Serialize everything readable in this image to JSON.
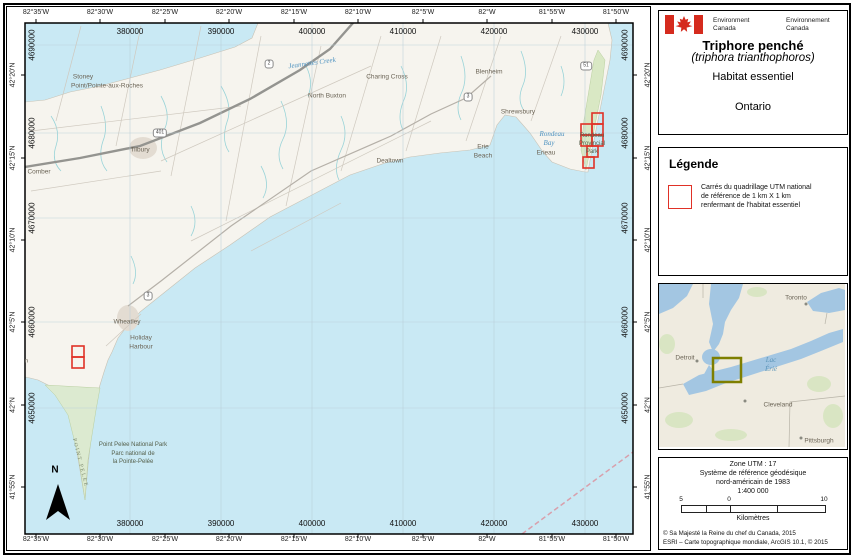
{
  "title_panel": {
    "env_en_1": "Environment",
    "env_en_2": "Canada",
    "env_fr_1": "Environnement",
    "env_fr_2": "Canada",
    "title": "Triphore penché",
    "species": "(triphora trianthophoros)",
    "subtitle": "Habitat essentiel",
    "region": "Ontario"
  },
  "legend": {
    "heading": "Légende",
    "item_line1": "Carrés du quadrillage UTM national",
    "item_line2": "de référence de 1 km X 1 km",
    "item_line3": "renfermant de l'habitat essentiel"
  },
  "inset": {
    "cities": {
      "toronto": "Toronto",
      "detroit": "Detroit",
      "cleveland": "Cleveland",
      "pittsburgh": "Pittsburgh"
    },
    "lake_line1": "Lac",
    "lake_line2": "Érié"
  },
  "info": {
    "zone": "Zone UTM : 17",
    "datum_line1": "Système de référence géodésique",
    "datum_line2": "nord-américain de 1983",
    "scale": "1:400 000",
    "bar_left": "5",
    "bar_zero": "0",
    "bar_right": "10",
    "bar_unit": "Kilomètres",
    "copyright_1": "© Sa Majesté la Reine du chef du Canada, 2015",
    "copyright_2": "ESRI – Carte topographique mondiale, ArcGIS 10.1, © 2015"
  },
  "axes": {
    "lon": [
      "82°35'W",
      "82°30'W",
      "82°25'W",
      "82°20'W",
      "82°15'W",
      "82°10'W",
      "82°5'W",
      "82°W",
      "81°55'W",
      "81°50'W"
    ],
    "lat": [
      "42°20'N",
      "42°15'N",
      "42°10'N",
      "42°5'N",
      "42°N",
      "41°55'N"
    ],
    "eastings": [
      "380000",
      "390000",
      "400000",
      "410000",
      "420000",
      "430000"
    ],
    "northings": [
      "4690000",
      "4680000",
      "4670000",
      "4660000",
      "4650000"
    ]
  },
  "places": {
    "stoney_1": "Stoney",
    "stoney_2": "Point/Pointe-aux-Roches",
    "tilbury": "Tilbury",
    "comber": "Comber",
    "creek": "Jeannettes Creek",
    "charing": "Charing Cross",
    "buxton": "North Buxton",
    "blenheim": "Blenheim",
    "shrewsbury": "Shrewsbury",
    "erieau": "Erieau",
    "erie_beach_1": "Erie",
    "erie_beach_2": "Beach",
    "dealtown": "Dealtown",
    "rondeau_bay_1": "Rondeau",
    "rondeau_bay_2": "Bay",
    "rondeau_park_1": "Rondeau",
    "rondeau_park_2": "Provincial",
    "rondeau_park_3": "Park",
    "wheatley": "Wheatley",
    "holiday_1": "Holiday",
    "holiday_2": "Harbour",
    "leamington": "Leamington",
    "pelee_park_1": "Point Pelee National Park",
    "pelee_park_2": "Parc national de",
    "pelee_park_3": "la Pointe-Pelée",
    "point_pelee": "POINT PELEE"
  },
  "highways": {
    "h401": "401",
    "h2": "2",
    "h3": "3",
    "h51": "51"
  },
  "north_arrow_label": "N",
  "colors": {
    "map_water": "#c9e9f4",
    "habitat_square": "#e03127",
    "study_area_box": "#7e7f00",
    "flag_red": "#d52b1e",
    "inset_water": "#a3c6e2"
  }
}
